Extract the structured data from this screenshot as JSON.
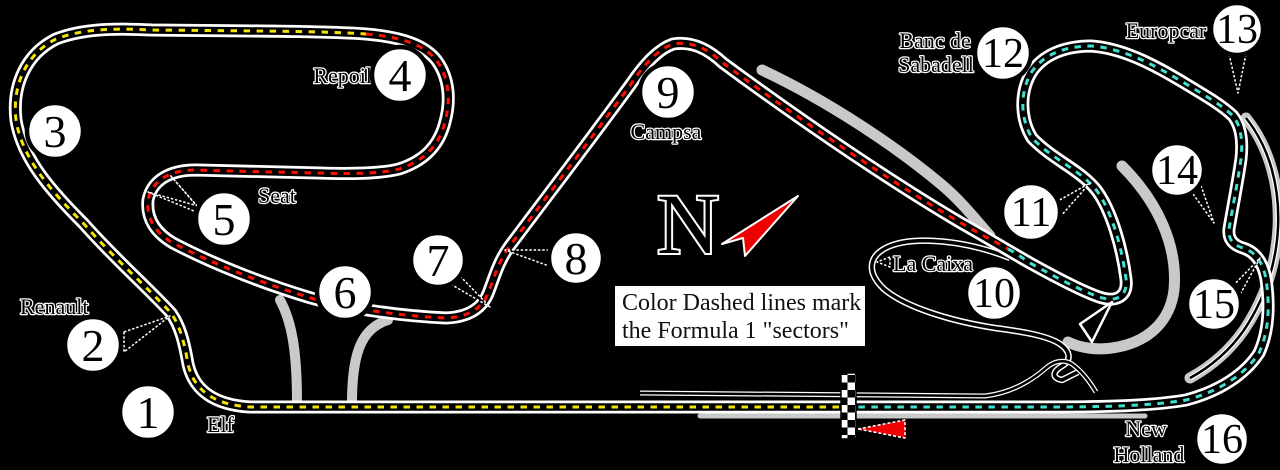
{
  "map_title": "Formula 1 circuit track map with numbered corners",
  "compass": {
    "letter": "N"
  },
  "legend": {
    "line1": "Color Dashed lines mark",
    "line2": "the Formula 1 \"sectors\""
  },
  "turns": [
    {
      "number": "1",
      "name": "Elf"
    },
    {
      "number": "2",
      "name": "Renault"
    },
    {
      "number": "3",
      "name": ""
    },
    {
      "number": "4",
      "name": "Repoil"
    },
    {
      "number": "5",
      "name": "Seat"
    },
    {
      "number": "6",
      "name": ""
    },
    {
      "number": "7",
      "name": ""
    },
    {
      "number": "8",
      "name": ""
    },
    {
      "number": "9",
      "name": "Campsa"
    },
    {
      "number": "10",
      "name": "La Caixa"
    },
    {
      "number": "11",
      "name": ""
    },
    {
      "number": "12",
      "name": "Banc de Sabadell",
      "line1": "Banc de",
      "line2": "Sabadell"
    },
    {
      "number": "13",
      "name": "Europcar"
    },
    {
      "number": "14",
      "name": ""
    },
    {
      "number": "15",
      "name": ""
    },
    {
      "number": "16",
      "name": "New Holland",
      "line1": "New",
      "line2": "Holland"
    }
  ],
  "colors": {
    "sector1_yellow": "#f2e400",
    "sector2_red": "#ff0f00",
    "sector3_teal": "#3fe0d0",
    "old_layout_grey": "#c9c9c9",
    "track_edge": "#ffffff",
    "direction_arrow_red": "#ee0000",
    "background": "#000000"
  }
}
